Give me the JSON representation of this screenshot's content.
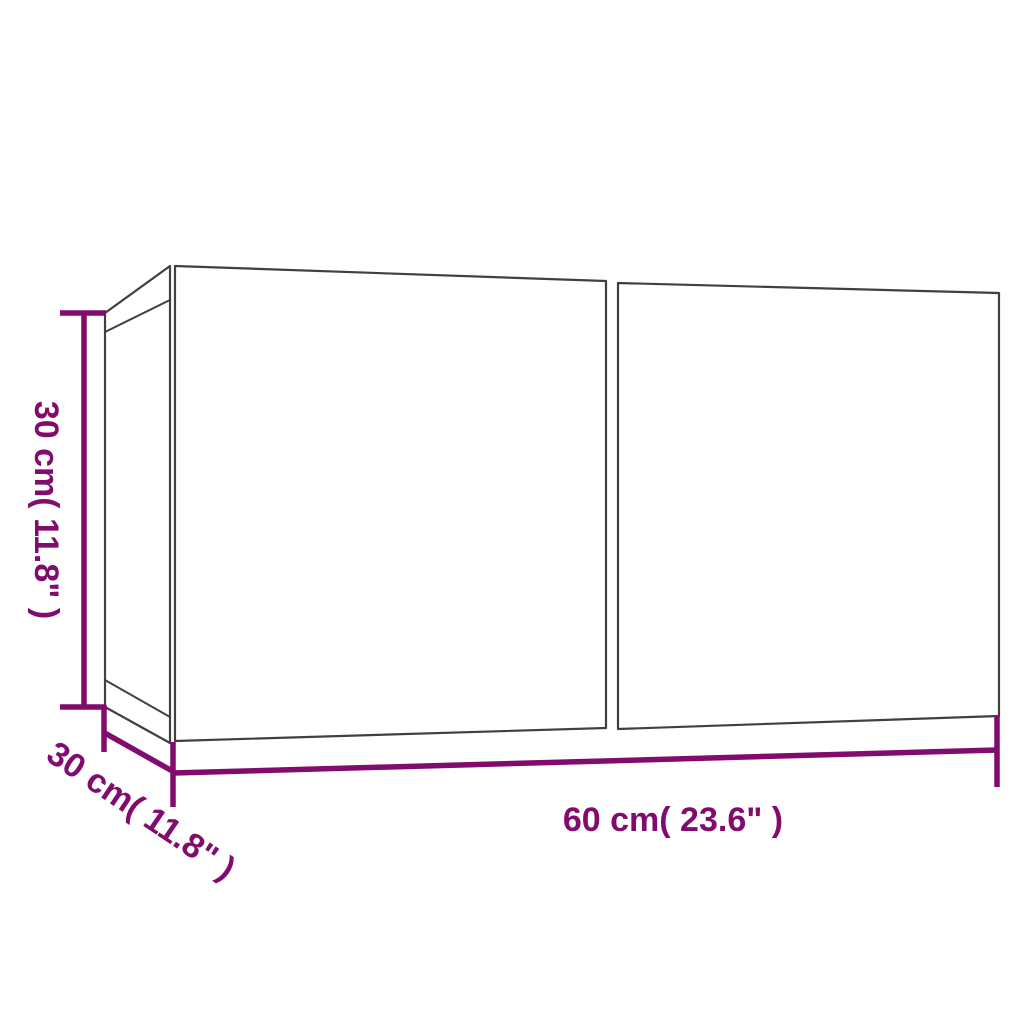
{
  "diagram": {
    "type": "product-dimension-drawing",
    "background": "#ffffff",
    "colors": {
      "dimension": "#810c6d",
      "outline": "#404040"
    },
    "labels": {
      "height": "30 cm( 11.8\" )",
      "depth": "30 cm( 11.8\" )",
      "width": "60 cm( 23.6\" )"
    },
    "dimensions": {
      "height_cm": 30,
      "height_in": 11.8,
      "depth_cm": 30,
      "depth_in": 11.8,
      "width_cm": 60,
      "width_in": 23.6
    }
  }
}
